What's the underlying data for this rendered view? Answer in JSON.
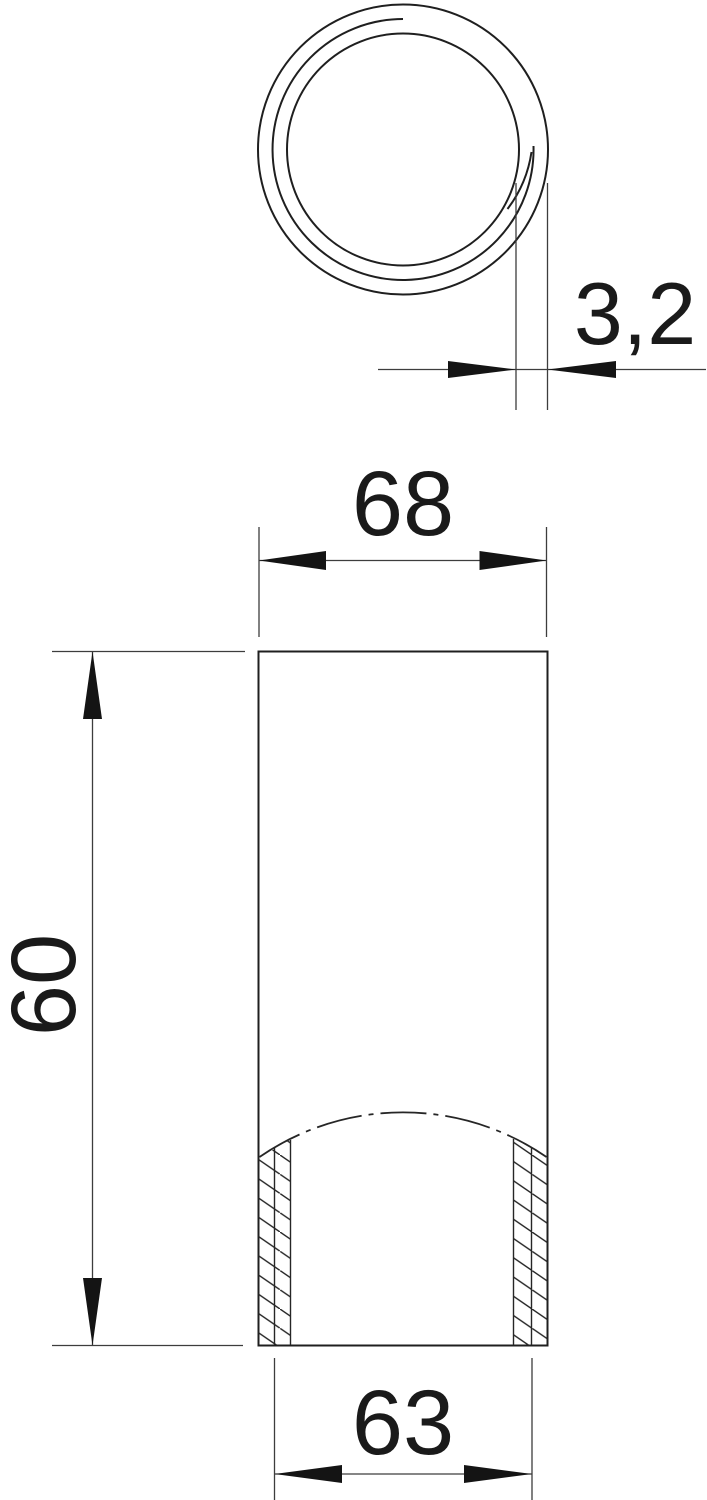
{
  "drawing": {
    "background_color": "#ffffff",
    "object_line_color": "#1f1f1f",
    "thin_line_color": "#3d3d3d",
    "arrow_color": "#141414",
    "dimensions": {
      "wall_thickness": {
        "label": "3,2"
      },
      "outer_width": {
        "label": "68"
      },
      "length": {
        "label": "60"
      },
      "inner_width": {
        "label": "63"
      }
    }
  }
}
